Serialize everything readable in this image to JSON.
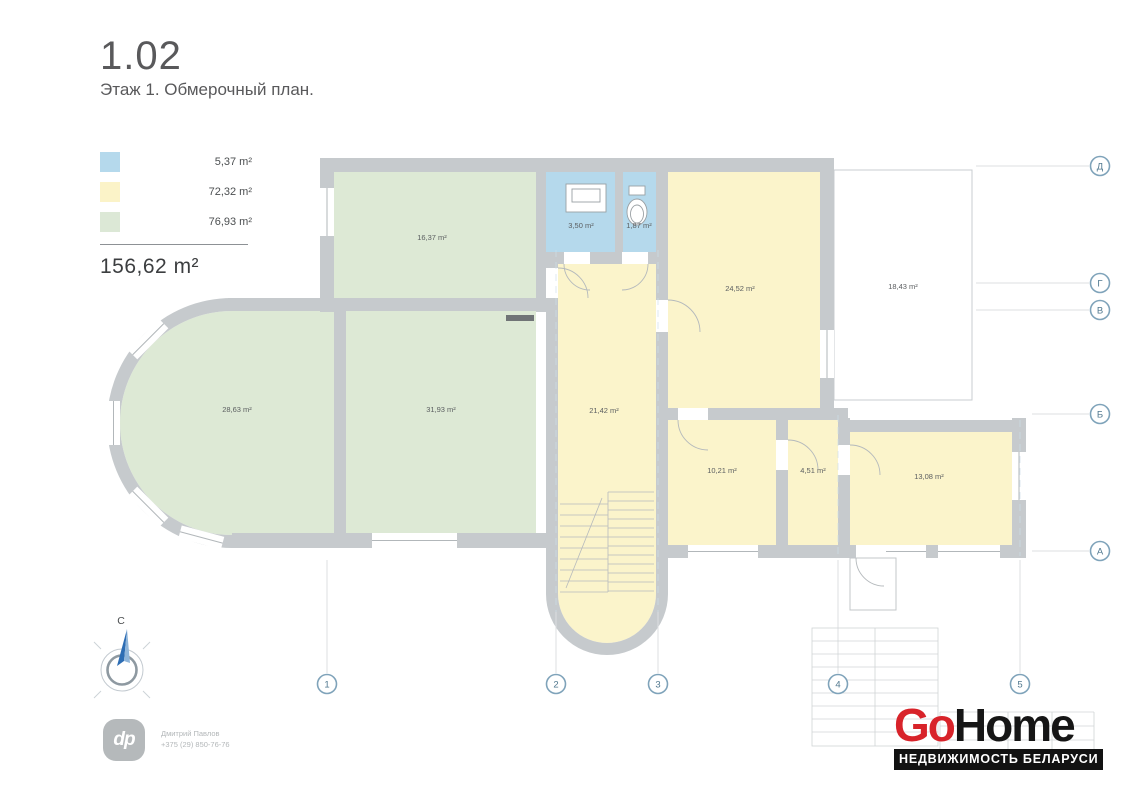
{
  "title": {
    "code": "1.02",
    "subtitle": "Этаж 1. Обмерочный план."
  },
  "legend": {
    "items": [
      {
        "id": "wet-zone",
        "color": "#b5d9ec",
        "area": "5,37 m²"
      },
      {
        "id": "common-zone",
        "color": "#fbf3c8",
        "area": "72,32 m²"
      },
      {
        "id": "living-zone",
        "color": "#dce8d6",
        "area": "76,93 m²"
      }
    ],
    "total": "156,62 m²"
  },
  "plan": {
    "colors": {
      "blue": "#b5d9ec",
      "yellow": "#fbf4cb",
      "green": "#dde9d5",
      "wall": "#c6cacd"
    },
    "rooms": [
      {
        "id": "room-top-left",
        "area": "16,37 m²"
      },
      {
        "id": "bathroom",
        "area": "3,50 m²"
      },
      {
        "id": "wc",
        "area": "1,87 m²"
      },
      {
        "id": "room-top-right",
        "area": "24,52 m²"
      },
      {
        "id": "terrace",
        "area": "18,43 m²"
      },
      {
        "id": "room-round-bay",
        "area": "28,63 m²"
      },
      {
        "id": "room-center",
        "area": "31,93 m²"
      },
      {
        "id": "hall-stairs",
        "area": "21,42 m²"
      },
      {
        "id": "room-small-1",
        "area": "10,21 m²"
      },
      {
        "id": "room-small-2",
        "area": "4,51 m²"
      },
      {
        "id": "room-right",
        "area": "13,08 m²"
      }
    ],
    "axes": {
      "rows": [
        "Д",
        "Г",
        "В",
        "Б",
        "А"
      ],
      "cols": [
        "1",
        "2",
        "3",
        "4",
        "5"
      ]
    },
    "compass": {
      "north": "С"
    }
  },
  "footer": {
    "agent": {
      "monogram": "dp",
      "name": "Дмитрий Павлов",
      "phone": "+375 (29) 850-76-76"
    },
    "brand": {
      "go": "Go",
      "home": "Home",
      "tagline": "НЕДВИЖИМОСТЬ БЕЛАРУСИ",
      "accent": "#d8232a"
    }
  }
}
